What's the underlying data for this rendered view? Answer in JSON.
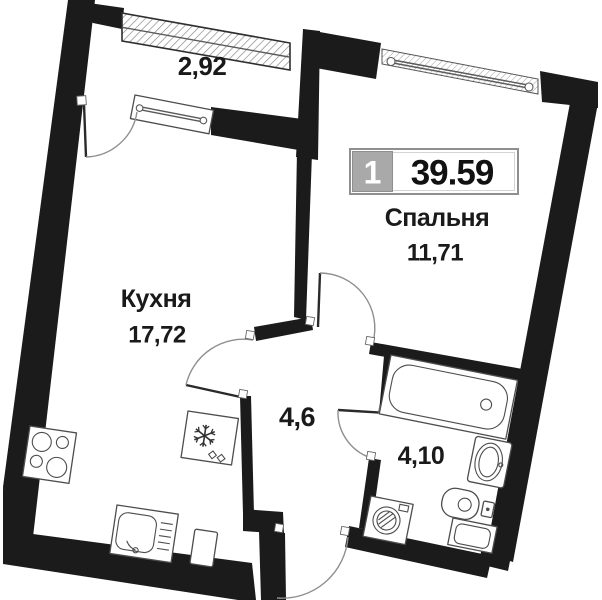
{
  "plan": {
    "badge": {
      "room_count": "1",
      "total_area": "39.59"
    },
    "rooms": {
      "balcony": {
        "area": "2,92"
      },
      "bedroom": {
        "name": "Спальня",
        "area": "11,71"
      },
      "kitchen": {
        "name": "Кухня",
        "area": "17,72"
      },
      "hallway": {
        "area": "4,6"
      },
      "bathroom": {
        "area": "4,10"
      }
    },
    "colors": {
      "wall": "#1b1b1b",
      "fixture_stroke": "#4d4d4d",
      "door_arc": "#8f8f8f",
      "window_hatch": "#8a8a8a",
      "badge_gray": "#a9a9a9",
      "text": "#1a1a1a"
    }
  }
}
